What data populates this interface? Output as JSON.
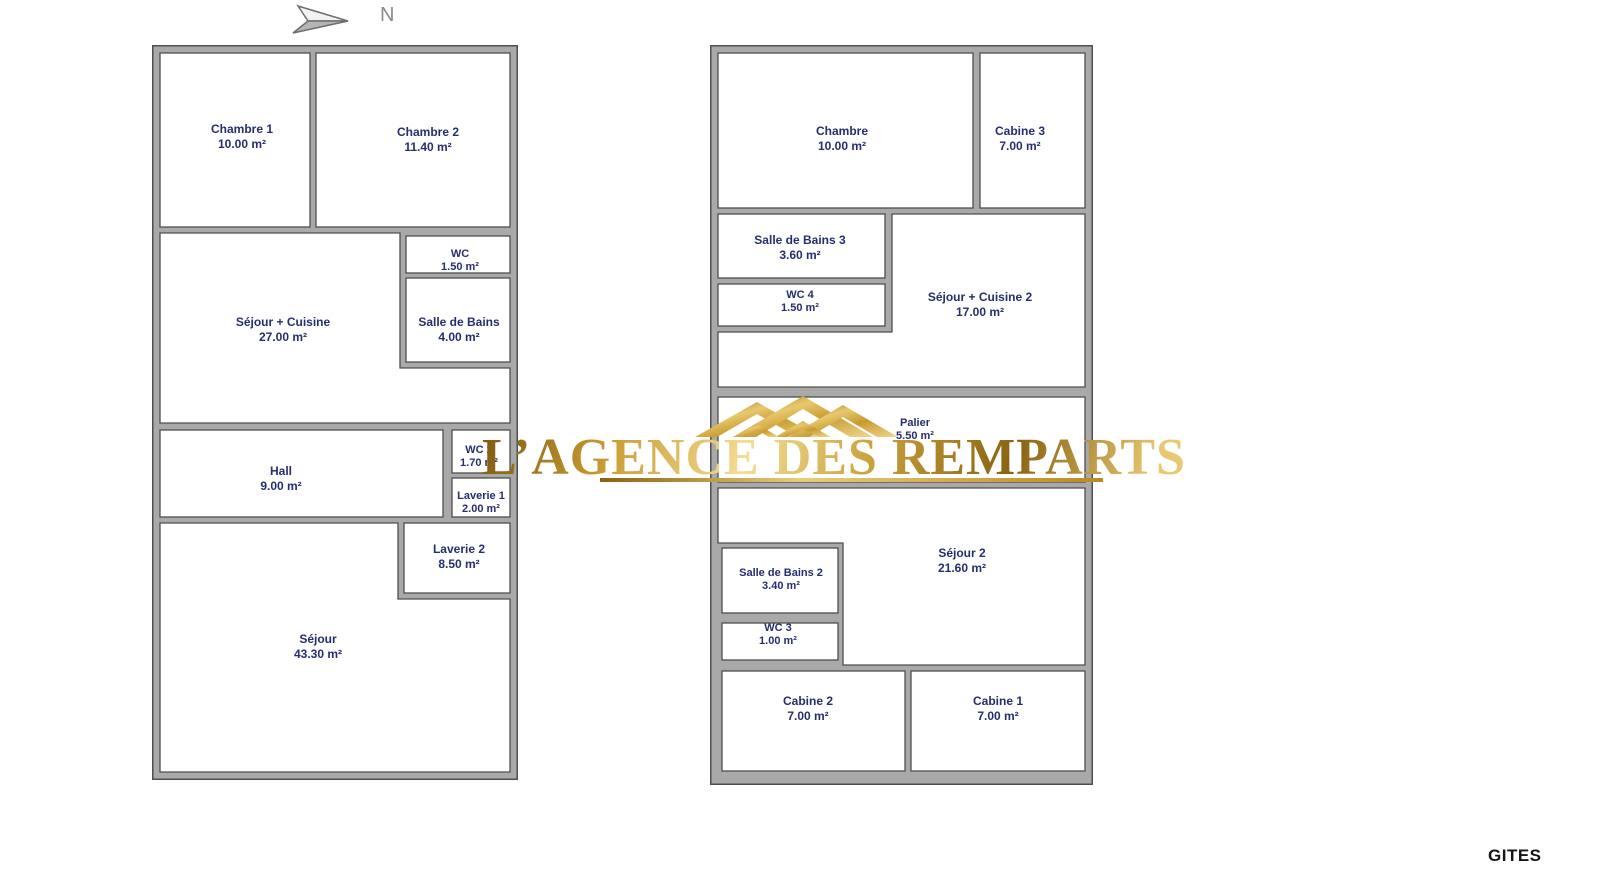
{
  "compass": {
    "label": "N"
  },
  "watermark": {
    "text": "L’AGENCE DES REMPARTS"
  },
  "footer": {
    "label": "GITES"
  },
  "colors": {
    "room_text": "#252e6e",
    "wall_fill": "#a9a9a9",
    "wall_line": "#4f4f4f",
    "gold_dark": "#8a6212",
    "gold_light": "#f5dd94"
  },
  "plans": [
    {
      "name": "left-floor-plan",
      "rooms": [
        {
          "key": "chambre-1",
          "name": "Chambre 1",
          "area": "10.00 m²"
        },
        {
          "key": "chambre-2",
          "name": "Chambre 2",
          "area": "11.40 m²"
        },
        {
          "key": "wc",
          "name": "WC",
          "area": "1.50 m²"
        },
        {
          "key": "sejour-cuisine",
          "name": "Séjour + Cuisine",
          "area": "27.00 m²"
        },
        {
          "key": "salle-de-bains",
          "name": "Salle de Bains",
          "area": "4.00 m²"
        },
        {
          "key": "hall",
          "name": "Hall",
          "area": "9.00 m²"
        },
        {
          "key": "wc-2",
          "name": "WC 2",
          "area": "1.70 m²"
        },
        {
          "key": "laverie-1",
          "name": "Laverie 1",
          "area": "2.00 m²"
        },
        {
          "key": "laverie-2",
          "name": "Laverie 2",
          "area": "8.50 m²"
        },
        {
          "key": "sejour",
          "name": "Séjour",
          "area": "43.30 m²"
        }
      ]
    },
    {
      "name": "right-floor-plan",
      "rooms": [
        {
          "key": "chambre",
          "name": "Chambre",
          "area": "10.00 m²"
        },
        {
          "key": "cabine-3",
          "name": "Cabine 3",
          "area": "7.00 m²"
        },
        {
          "key": "salle-de-bains-3",
          "name": "Salle de Bains 3",
          "area": "3.60 m²"
        },
        {
          "key": "wc-4",
          "name": "WC 4",
          "area": "1.50 m²"
        },
        {
          "key": "sejour-cuisine-2",
          "name": "Séjour + Cuisine 2",
          "area": "17.00 m²"
        },
        {
          "key": "palier",
          "name": "Palier",
          "area": "5.50 m²"
        },
        {
          "key": "sejour-2",
          "name": "Séjour 2",
          "area": "21.60 m²"
        },
        {
          "key": "salle-de-bains-2",
          "name": "Salle de Bains 2",
          "area": "3.40 m²"
        },
        {
          "key": "wc-3",
          "name": "WC 3",
          "area": "1.00 m²"
        },
        {
          "key": "cabine-2",
          "name": "Cabine 2",
          "area": "7.00 m²"
        },
        {
          "key": "cabine-1",
          "name": "Cabine 1",
          "area": "7.00 m²"
        }
      ]
    }
  ]
}
